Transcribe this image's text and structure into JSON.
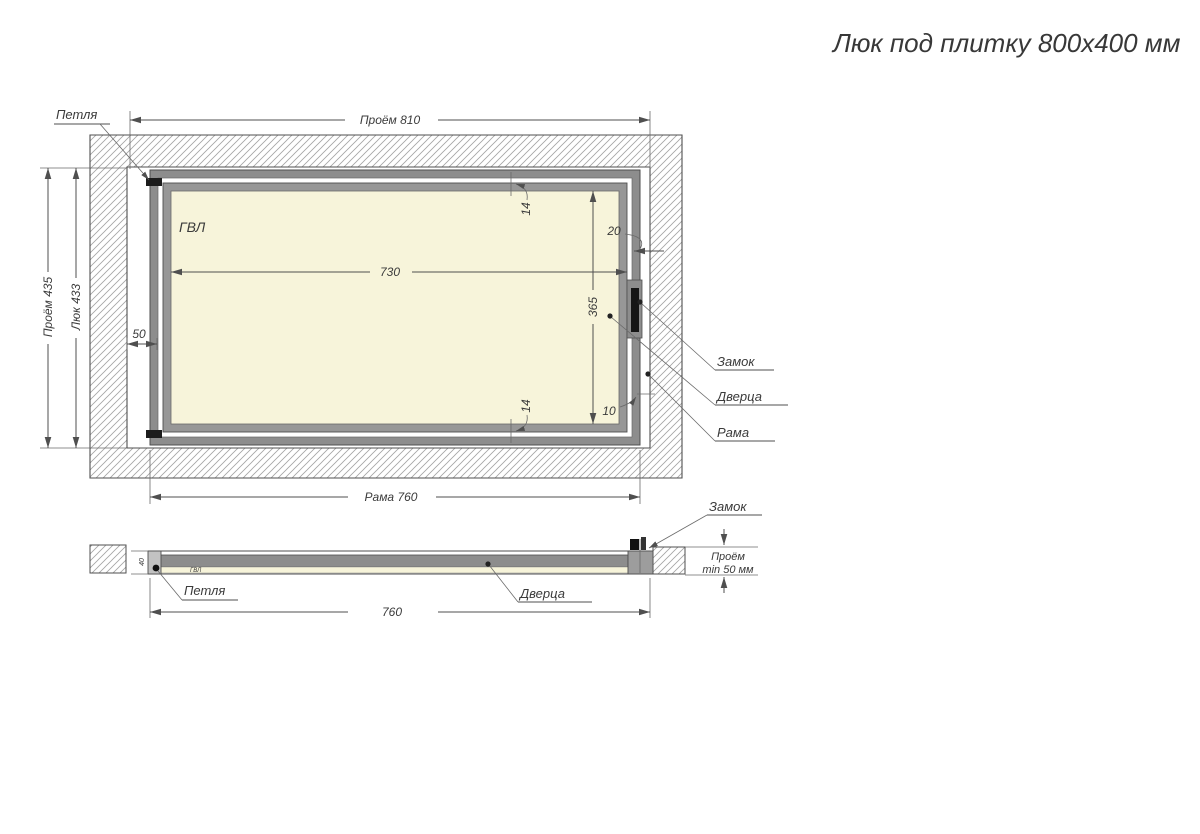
{
  "title": "Люк под плитку 800х400 мм",
  "top_view": {
    "material": "ГВЛ",
    "dim_opening_w": "Проём 810",
    "dim_opening_h": "Проём 435",
    "dim_hatch_h": "Люк 433",
    "dim_door_w": "730",
    "dim_door_h": "365",
    "dim_offset_left": "50",
    "dim_gap_top": "14",
    "dim_gap_bottom": "14",
    "dim_gap_right_top": "20",
    "dim_gap_right_bottom": "10",
    "dim_frame_w": "Рама 760",
    "label_hinge": "Петля",
    "label_lock": "Замок",
    "label_door": "Дверца",
    "label_frame": "Рама"
  },
  "side_view": {
    "label_hinge": "Петля",
    "label_door": "Дверца",
    "label_lock": "Замок",
    "material": "ГВЛ",
    "dim_frame_w": "760",
    "dim_depth": "40",
    "clearance_line1": "Проём",
    "clearance_line2": "min 50 мм"
  },
  "colors": {
    "frame_gray": "#8d8d8d",
    "panel_cream": "#f7f4da",
    "line": "#4f4f4f",
    "hatch": "#a3a3a3"
  }
}
